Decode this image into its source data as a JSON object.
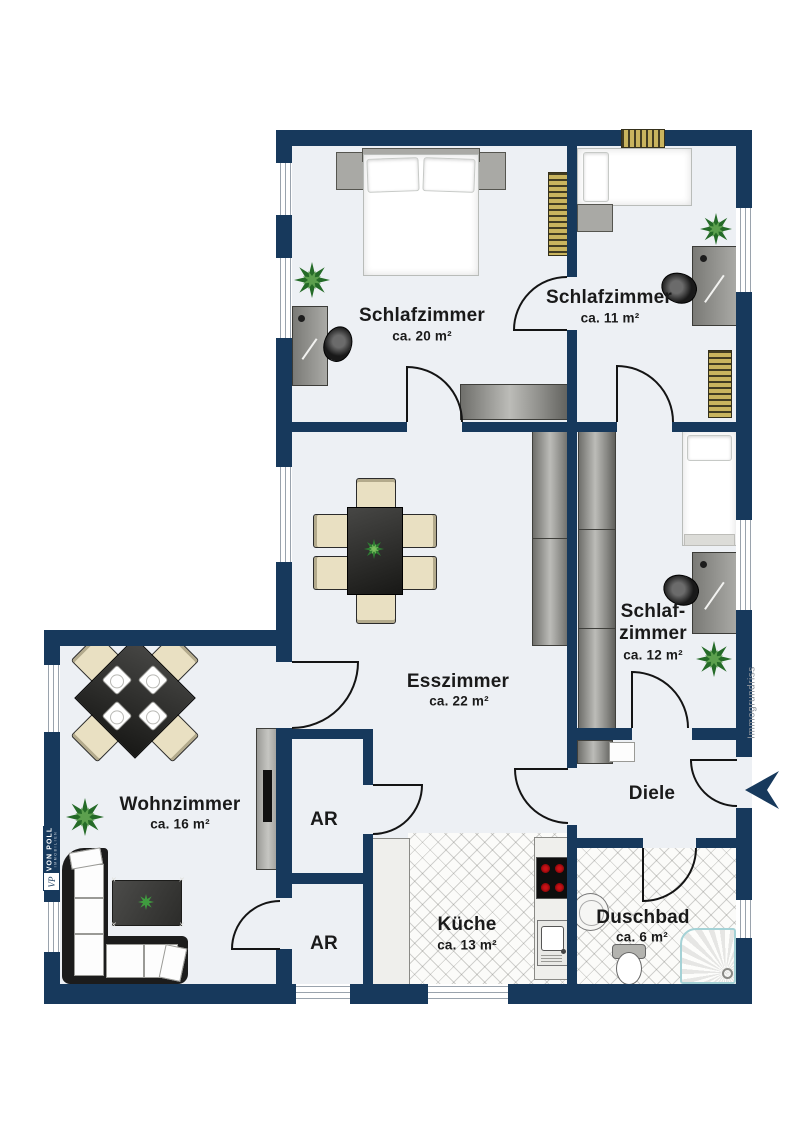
{
  "watermark": "Immogrundriss",
  "brand": {
    "line1": "VON POLL",
    "line2": "IMMOBILIEN",
    "monogram": "VP"
  },
  "rooms": [
    {
      "id": "schlafzimmer-20",
      "name": "Schlafzimmer",
      "area": "ca. 20 m²"
    },
    {
      "id": "schlafzimmer-11",
      "name": "Schlafzimmer",
      "area": "ca. 11 m²"
    },
    {
      "id": "schlafzimmer-12",
      "name_line1": "Schlaf-",
      "name_line2": "zimmer",
      "area": "ca. 12 m²"
    },
    {
      "id": "esszimmer",
      "name": "Esszimmer",
      "area": "ca. 22 m²"
    },
    {
      "id": "wohnzimmer",
      "name": "Wohnzimmer",
      "area": "ca. 16 m²"
    },
    {
      "id": "abstellraum-1",
      "name": "AR"
    },
    {
      "id": "abstellraum-2",
      "name": "AR"
    },
    {
      "id": "kueche",
      "name": "Küche",
      "area": "ca. 13 m²"
    },
    {
      "id": "duschbad",
      "name": "Duschbad",
      "area": "ca. 6 m²"
    },
    {
      "id": "diele",
      "name": "Diele"
    }
  ],
  "colors": {
    "wall_navy": "#17395c",
    "floor": "#edf0f4",
    "plant_green": "#2e7d32",
    "burner_red": "#cf1218",
    "radiator_gold": "#c9b45e"
  }
}
